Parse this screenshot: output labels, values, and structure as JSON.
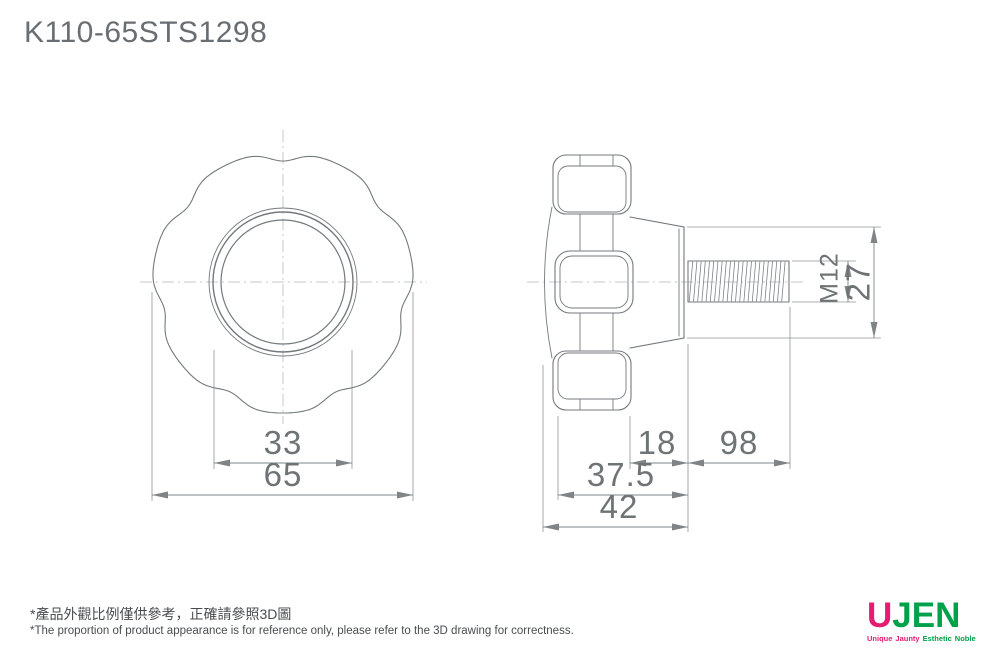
{
  "title": "K110-65STS1298",
  "front_view": {
    "dim_hub_diameter": "33",
    "dim_knob_diameter": "65"
  },
  "side_view": {
    "dim_boss_length": "18",
    "dim_thread_length": "98",
    "dim_body_depth": "37.5",
    "dim_total_depth": "42",
    "thread_spec": "M12",
    "dim_boss_diameter": "27"
  },
  "footnote": {
    "zh": "*產品外觀比例僅供參考，正確請參照3D圖",
    "en": "*The proportion of product appearance is for reference only, please refer to the 3D drawing for correctness."
  },
  "logo": {
    "brand_left": "U",
    "brand_left_color": "#e61c73",
    "brand_right": "JEN",
    "brand_right_color": "#00a14b",
    "tagline_words": [
      {
        "text": "Unique",
        "color": "#e61c73"
      },
      {
        "text": "Jaunty",
        "color": "#e61c73"
      },
      {
        "text": "Esthetic",
        "color": "#00a14b"
      },
      {
        "text": "Noble",
        "color": "#00a14b"
      }
    ]
  }
}
